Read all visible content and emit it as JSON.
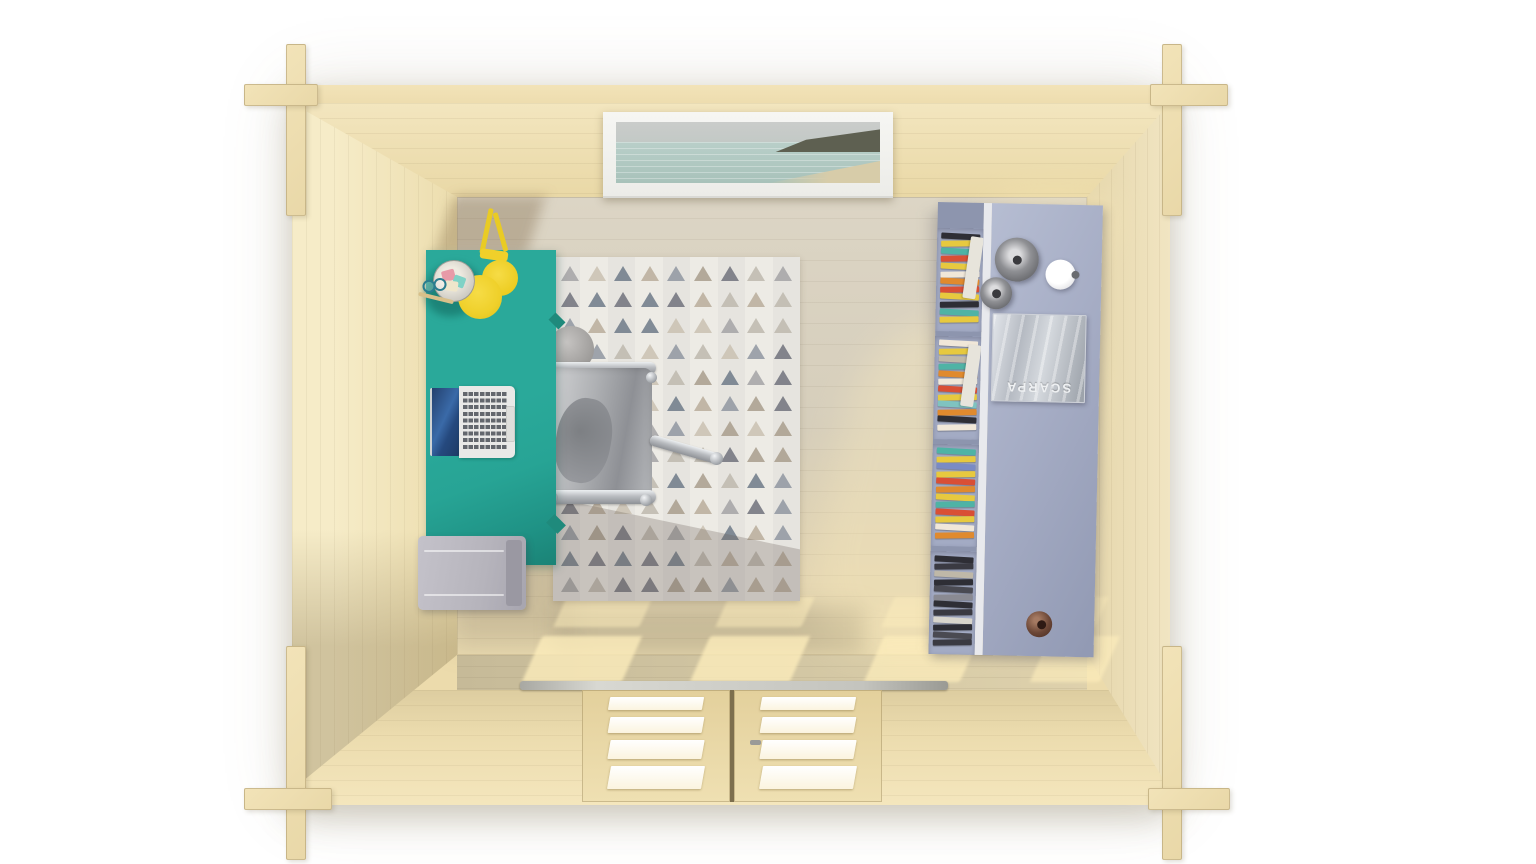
{
  "scene": {
    "type": "3d-render",
    "subject": "Top-down view of a wooden log-cabin garden office interior",
    "shelf": {
      "magazine_label": "SCARPA"
    },
    "palette": {
      "background": "#ffffff",
      "wall_wood": "#ecdbac",
      "wall_wood_light": "#f5eac6",
      "floor_wood": "#d8d0bd",
      "floor_sunlight": "#ffefbd",
      "desk_teal": "#27a495",
      "desk_teal_dark": "#1b8376",
      "lamp_yellow": "#f0d02a",
      "drawer_grey": "#b6b4bc",
      "rug_white": "#edebe5",
      "chair_silver": "#aeb0b3",
      "shelf_blue_grey": "#a6adc5",
      "door_wood": "#e9d8a6",
      "door_pane_white": "#ffffff",
      "threshold_metal": "#c2c2bc",
      "knob_brown": "#6b4636",
      "sea_view": "#b7cdc7"
    }
  },
  "decor": {
    "rug": {
      "rows": 13,
      "cols": 9,
      "palette": [
        "#a3a3a6",
        "#b9ad9b",
        "#70727c",
        "#c9c1b2",
        "#8f97a1",
        "#bdb9ae",
        "#6d7a88",
        "#a89d8d"
      ]
    },
    "books": {
      "cells": [
        {
          "papers": true,
          "books": [
            "#2e2e35",
            "#e7c93f",
            "#4fb3a5",
            "#d94f35",
            "#e7c93f",
            "#f0e7d8",
            "#e08a2e",
            "#d94f35",
            "#e7c93f",
            "#2e2e35",
            "#4fb3a5",
            "#e7c93f"
          ]
        },
        {
          "papers": true,
          "books": [
            "#f0e7d8",
            "#e7c93f",
            "#bfb8a8",
            "#4fb3a5",
            "#e08a2e",
            "#f0e7d8",
            "#d94f35",
            "#e7c93f",
            "#7fc3c0",
            "#e08a2e",
            "#2e2e35",
            "#f0e7d8"
          ]
        },
        {
          "papers": false,
          "books": [
            "#4fb3a5",
            "#e7c93f",
            "#7a8bc4",
            "#e7c93f",
            "#d94f35",
            "#e08a2e",
            "#e7c93f",
            "#4fb3a5",
            "#d94f35",
            "#e7c93f",
            "#f0e7d8",
            "#e08a2e"
          ]
        },
        {
          "papers": false,
          "books": [
            "#2e2e35",
            "#3a3a42",
            "#bfb8a8",
            "#2e2e35",
            "#4a4a52",
            "#8a8a92",
            "#2e2e35",
            "#3a3a42",
            "#d8d5cc",
            "#2e2e35",
            "#4a4a52",
            "#3a3a42"
          ]
        }
      ]
    },
    "door": {
      "leaves": 2,
      "pane_heights": [
        13,
        16,
        19,
        23
      ]
    },
    "sun_patches": [
      {
        "x": 560,
        "y": 597,
        "w": 86,
        "h": 30,
        "o": 0.5
      },
      {
        "x": 722,
        "y": 597,
        "w": 86,
        "h": 30,
        "o": 0.5
      },
      {
        "x": 888,
        "y": 597,
        "w": 80,
        "h": 30,
        "o": 0.45
      },
      {
        "x": 1042,
        "y": 597,
        "w": 60,
        "h": 30,
        "o": 0.4
      },
      {
        "x": 532,
        "y": 636,
        "w": 100,
        "h": 46,
        "o": 0.75
      },
      {
        "x": 700,
        "y": 636,
        "w": 100,
        "h": 46,
        "o": 0.75
      },
      {
        "x": 874,
        "y": 636,
        "w": 96,
        "h": 46,
        "o": 0.7
      },
      {
        "x": 1040,
        "y": 636,
        "w": 70,
        "h": 46,
        "o": 0.6
      },
      {
        "x": 986,
        "y": 198,
        "w": 120,
        "h": 64,
        "o": 0.4,
        "soft": true
      },
      {
        "x": 830,
        "y": 320,
        "w": 250,
        "h": 330,
        "o": 0.3,
        "soft": true
      }
    ]
  }
}
